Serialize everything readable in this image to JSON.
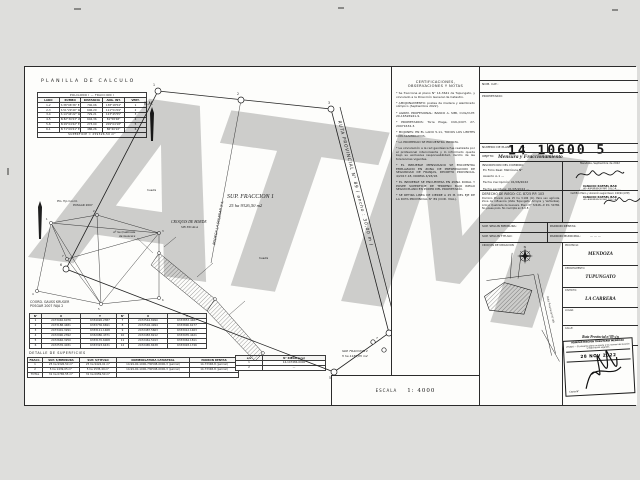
{
  "watermark": "ATM",
  "planilla": {
    "title": "PLANILLA  DE  CALCULO",
    "subtitle": "POLIGONO  I   —   FRACCION  I",
    "headers": [
      "LADO",
      "RUMBO",
      "DISTANCIA",
      "ANG. INT.",
      "VERT."
    ],
    "rows": [
      [
        "1-2",
        "S 38°06'36\" E",
        "740,06",
        "138°18'54\"",
        "1"
      ],
      [
        "2-3",
        "S 51°29'40\" W",
        "606,29",
        "111°51'09\"",
        "2"
      ],
      [
        "3-4",
        "S 14°44'22\" W",
        "729,21",
        "123°45'55\"",
        "3"
      ],
      [
        "4-5",
        "N 82°30'23\" W",
        "604,36",
        "81°58'48\"",
        "4"
      ],
      [
        "5-6",
        "N 09°04'42\" E",
        "273,00",
        "209°04'18\"",
        "5"
      ],
      [
        "6-1",
        "N 71°09'41\" E",
        "486,26",
        "86°40'22\"",
        "6"
      ]
    ],
    "footer": "SUPERFICIE   =   259326,50 m²"
  },
  "triangulacion": {
    "note_line1": "Pto. fijo Coord.",
    "note_line2": "POSGAR 2007",
    "node_labels": [
      "1",
      "2",
      "3",
      "4",
      "5",
      "6",
      "7"
    ]
  },
  "coords": {
    "title_line1": "COORD. GAUSS KRUGER",
    "title_line2": "POSGAR 2007 FAJA 2",
    "headers": [
      "N°",
      "X",
      "Y"
    ],
    "table1": [
      [
        "1",
        "2473046.6076",
        "6334026.2387"
      ],
      [
        "2",
        "2473188.4481",
        "6333736.6691"
      ],
      [
        "3",
        "2473401.3291",
        "6333111.1468"
      ],
      [
        "4",
        "2472990.2392",
        "6332980.4371"
      ],
      [
        "5",
        "2472646.3250",
        "6333170.6008"
      ],
      [
        "6",
        "2472576.4031",
        "6333323.6431"
      ]
    ],
    "table2": [
      [
        "7",
        "2472544.8990",
        "6333853.4487"
      ],
      [
        "8",
        "2472504.4994",
        "6333890.6177"
      ],
      [
        "9",
        "2472487.5663",
        "6333912.1463"
      ],
      [
        "10",
        "2472483.8212",
        "6333935.4421"
      ],
      [
        "11",
        "2472461.5013",
        "6333964.1811"
      ],
      [
        "12",
        "2472465.8438",
        "6333993.1746"
      ]
    ]
  },
  "superficies": {
    "title": "DETALLE  DE  SUPERFICIES",
    "headers": [
      "FRACC.",
      "SUP. S/MENSURA",
      "SUP. S/TITULO",
      "NOMENCLATURA CATASTRAL",
      "PADRON RENTAS"
    ],
    "rows": [
      [
        "1",
        "25 ha 9326,50 m²",
        "25 ha 9424,01 m²",
        "14-99-00-1000-730598-0000-3 (parcial)",
        "14-73348-8 (parcial)"
      ],
      [
        "2",
        "5 ha 1439,05 m²",
        "5 ha 1535,49 m²",
        "14-99-00-1000-730598-0000-3 (parcial)",
        "14-73348-8 (parcial)"
      ],
      [
        "TOTAL",
        "31 ha 0765,55 m²",
        "31 ha 0959,50 m²",
        "",
        ""
      ]
    ]
  },
  "riego_tabla": {
    "headers": [
      "s/u",
      "N° RIEGO (s/u)"
    ],
    "rows": [
      [
        "1",
        "14-147484-0000"
      ],
      [
        "2",
        "—"
      ]
    ]
  },
  "drawing": {
    "north_label": "N.M.",
    "road_label": "RUTA  PROVINCIAL  N°  89  ( ancho :  30,00 m )",
    "parcel_title": "SUP.  FRACCION  1",
    "parcel_area": "25 ha 9326,50 m2",
    "parcel2_title": "SUP. FRACCION 2",
    "parcel2_area": "5 ha 1439,05 m2",
    "side_label": "BODEGA LA SOLEDAD S.A.",
    "huella_label": "huella",
    "croquis_borde_title": "CROQUIS  DE  BORDE",
    "croquis_borde_sub": "SIN  ESCALA",
    "arroyo_line1": "Aº Sa Quebrada",
    "arroyo_line2": "de Guevara",
    "vertices": [
      "1",
      "2",
      "3",
      "4",
      "5",
      "6",
      "7"
    ]
  },
  "scale": {
    "label": "ESCALA",
    "value": "1: 4000"
  },
  "certificaciones": {
    "title_line1": "CERTIFICACIONES,",
    "title_line2": "OBSERVACIONES  Y  NOTAS",
    "notes": [
      "* Se fracciona el plano N° 14-3641 de Tupungato, y vinculado a la Dirección General de Catastro.",
      "* AMOJONAMIENTO: postes de madera y alambrado olímpico (Septiembre 2022).",
      "* AGRIM. PROFESIONAL: BANCO A. SIMI, CUIL/CUIT. 20-16526941-9.",
      "* PROPIETARIOS: Torre Plage, CUIL/CUIT. 27-29971634-3.",
      "* MOJONES: EN EL LADO 5-11, TODOS LOS LIMITES CON ALAMBRADOS.",
      "* LA PROPIEDAD SE ENCUENTRA INCULTA.",
      "* La vinculación a la red geodésica fue realizada por el profesional interviniente y lo informado queda bajo su exclusiva responsabilidad, dentro de las tolerancias vigentes.",
      "* EL INMUEBLE MENSURADO SE ENCUENTRA EMPLAZADO EN ZONA DE PRESERVACION DE SEGURIDAD DE FRANJAS, DECRETO PROVINCIAL 4/2017-18, NORMA 4/93/18.",
      "* EL INMUEBLE SE ENCUENTRA EN ZONA RURAL Y POSEE SUPERFICIE DE TERRENO BAJO RIEGO SEGUN PLANO EN PODER DEL PROPIETARIO.",
      "* SE RETIRA LINEA DE CIERRE A 25 M. DEL EJE DE LA RUTA PROVINCIAL N° 89 (COD. VIAL)."
    ]
  },
  "panel": {
    "nom_cat_label": "NOM. CAT.:",
    "propietario_label": "PROPIETARIO:",
    "stamp_number": "14 10600 5",
    "plano_label": "NUMERO DE PLANO:",
    "plano_value": "14-",
    "objeto_label": "OBJETO:",
    "objeto_value": "Mensura y Fraccionamiento",
    "dominio_label": "INSCRIPCION DEL DOMINIO:",
    "dominio_lines": [
      "En Folio Real: Matrícula N°",
      "Asiento A-1  —",
      "Fecha inscripción: 01/06/2022",
      "Fecha escritura: 01/05/2022  —"
    ],
    "firma1": {
      "fecha": "Mendoza, Septiembre de 2022",
      "nombre": "IGNACIO RAFAEL BAR",
      "titulo": "AG. AGRIMENSOR  MAT. 709 C.A.",
      "nota": "SOBRE LIM. TERRENO S/LO EXPRESADO"
    },
    "riego_label": "DERECHO DE RIEGO:  CC. 8725  P.P. 103",
    "riego_text": "Dominio Privado para 25 ha 3.196 (m). Para uso agrícola. Zona de influencia (Valle Tupungato, Arroyos y Vertientes). Arroyo Quebrada de Guevara. Plano N° 72448—P. P.C. 54780. No posee pozo. No inscripta en R.U.E.",
    "firma2": {
      "caption": "Certifico Plano y ubicación según Resol. 140/94 (ATM)",
      "nombre": "IGNACIO RAFAEL BAR",
      "titulo": "AG. AGRIMENSOR  MAT. 709 C.A."
    },
    "sup_mensura_label": "SUP. SEGUN MENSURA:",
    "padron_rentas_label": "PADRON RENTAS:",
    "sup_titulo_label": "SUP. SEGUN TITULO:",
    "padron_municipal_label": "PADRON MUNICIPAL:",
    "padron_municipal_value": "—   —   —",
    "croquis_label": "CROQUIS  DE  UBICACION",
    "croquis_road_label": "Ruta Provincial N° 89",
    "ubicacion": {
      "provincia_label": "PROVINCIA:",
      "provincia": "MENDOZA",
      "departamento_label": "DEPARTAMENTO:",
      "departamento": "TUPUNGATO",
      "distrito_label": "DISTRITO:",
      "distrito": "LA CARRERA",
      "lugar_label": "LUGAR:",
      "lugar": "",
      "calle_label": "CALLE:",
      "calle": "Ruta Provincial n°89 s/n"
    },
    "visado": {
      "linea1": "ADMINISTRACION TRIBUTARIA MENDOZA",
      "linea2": "VISADO — El presente plano se ajusta a las normas de visación y registración vigentes",
      "fecha": "28 NOV 2022",
      "copia_label": "Copia N°"
    }
  }
}
